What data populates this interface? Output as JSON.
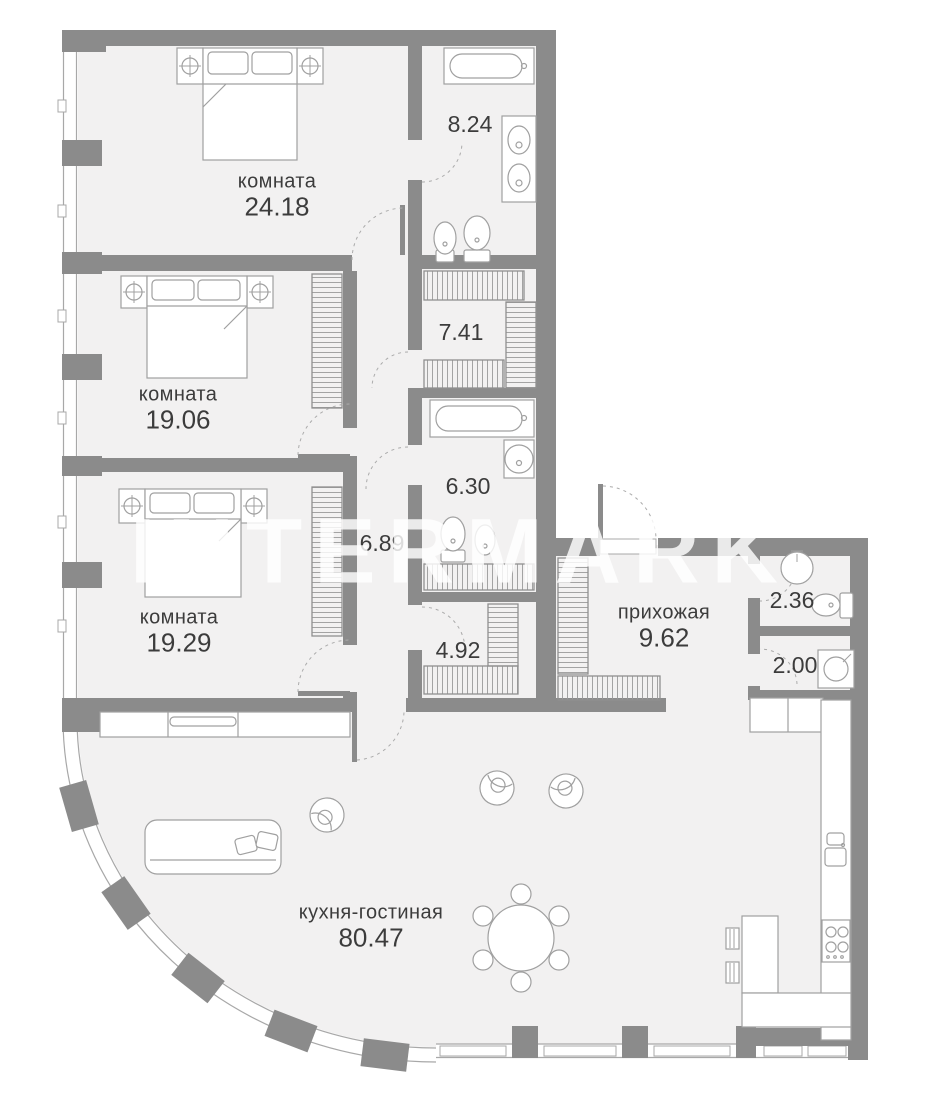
{
  "watermark": "INTERMARK",
  "colors": {
    "wall": "#8b8b8b",
    "floor": "#f2f1f1",
    "line": "#a0a0a0",
    "label": "#3c3c3c"
  },
  "rooms": [
    {
      "id": "bedroom-1",
      "name": "комната",
      "area": "24.18"
    },
    {
      "id": "bedroom-2",
      "name": "комната",
      "area": "19.06"
    },
    {
      "id": "bedroom-3",
      "name": "комната",
      "area": "19.29"
    },
    {
      "id": "kitchen-living",
      "name": "кухня-гостиная",
      "area": "80.47"
    },
    {
      "id": "hallway",
      "name": "прихожая",
      "area": "9.62"
    },
    {
      "id": "bathroom-main",
      "name": "",
      "area": "8.24"
    },
    {
      "id": "walkin-closet",
      "name": "",
      "area": "7.41"
    },
    {
      "id": "bathroom-2",
      "name": "",
      "area": "6.30"
    },
    {
      "id": "corridor",
      "name": "",
      "area": "6.89"
    },
    {
      "id": "closet-2",
      "name": "",
      "area": "4.92"
    },
    {
      "id": "wc",
      "name": "",
      "area": "2.36"
    },
    {
      "id": "laundry",
      "name": "",
      "area": "2.00"
    }
  ],
  "furniture_icons": [
    "double-bed",
    "nightstand-lamp",
    "wardrobe-hatch",
    "bathtub",
    "double-vanity-sink",
    "pedestal-sink",
    "toilet",
    "bidet",
    "washing-machine",
    "kitchen-counter",
    "kitchen-sink",
    "stove-4-burner",
    "kitchen-island",
    "bar-stool",
    "dining-table-6-chairs",
    "armchair",
    "sofa",
    "sideboard",
    "door-swing",
    "window"
  ]
}
